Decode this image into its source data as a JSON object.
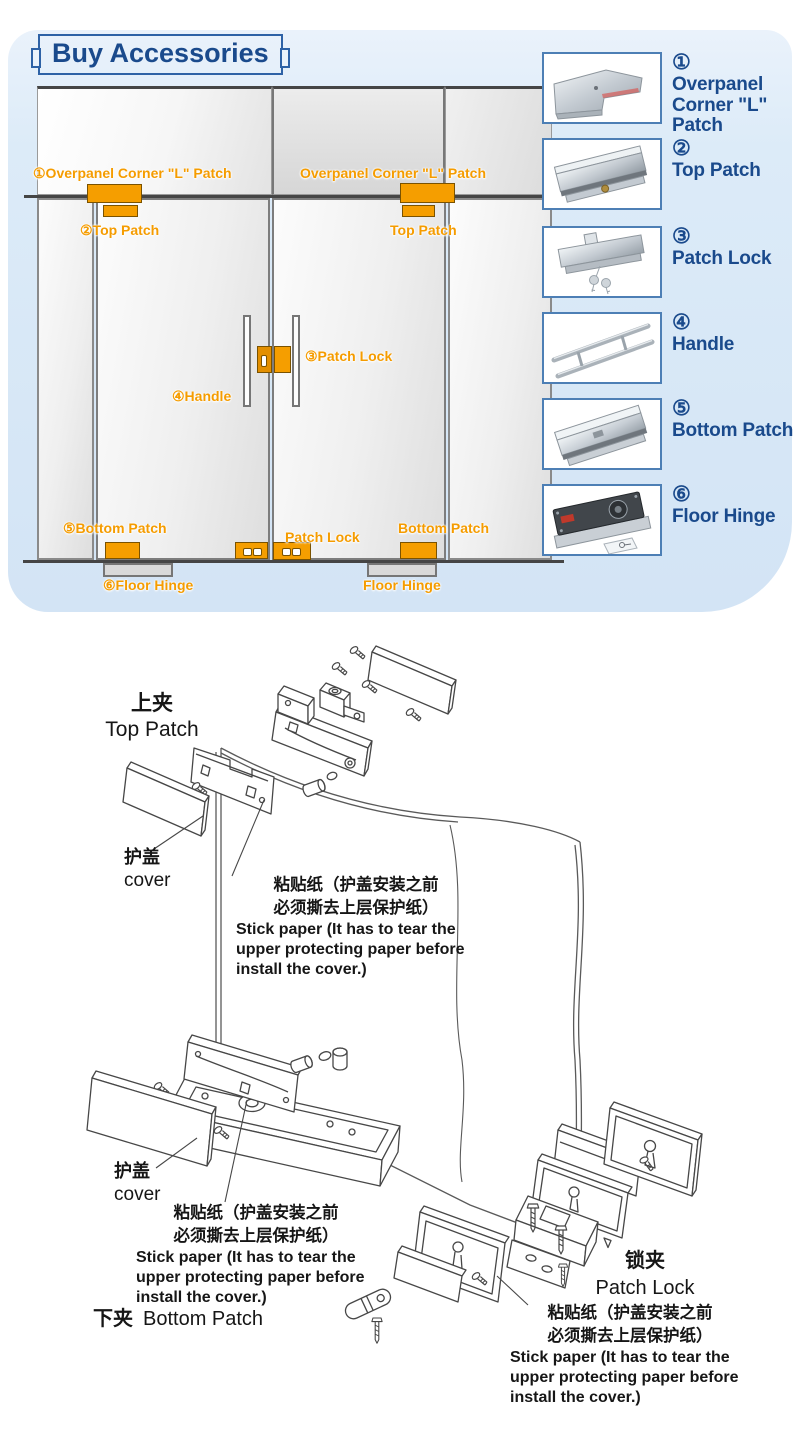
{
  "header": {
    "title": "Buy Accessories"
  },
  "door_diagram": {
    "overpanel_left": "①Overpanel Corner \"L\" Patch",
    "overpanel_right": "Overpanel Corner \"L\" Patch",
    "top_patch_left": "②Top Patch",
    "top_patch_right": "Top Patch",
    "patch_lock_mid": "③Patch Lock",
    "handle": "④Handle",
    "bottom_patch_left": "⑤Bottom Patch",
    "patch_lock_bottom": "Patch Lock",
    "bottom_patch_right": "Bottom Patch",
    "floor_hinge_left": "⑥Floor Hinge",
    "floor_hinge_right": "Floor Hinge"
  },
  "products": [
    {
      "number": "①",
      "label": "Overpanel Corner \"L\" Patch",
      "icon": "corner-l-patch"
    },
    {
      "number": "②",
      "label": "Top Patch",
      "icon": "top-patch"
    },
    {
      "number": "③",
      "label": "Patch Lock",
      "icon": "patch-lock"
    },
    {
      "number": "④",
      "label": "Handle",
      "icon": "door-handle"
    },
    {
      "number": "⑤",
      "label": "Bottom Patch",
      "icon": "bottom-patch"
    },
    {
      "number": "⑥",
      "label": "Floor Hinge",
      "icon": "floor-hinge"
    }
  ],
  "exploded": {
    "top_patch_cn": "上夹",
    "top_patch_en": "Top Patch",
    "cover_cn": "护盖",
    "cover_en": "cover",
    "stick_cn1": "粘贴纸（护盖安装之前",
    "stick_cn2": "必须撕去上层保护纸）",
    "stick_en1": "Stick paper (It has to tear the",
    "stick_en2": "upper protecting paper before",
    "stick_en3": "install the cover.)",
    "bottom_patch_cn": "下夹",
    "bottom_patch_en": "Bottom Patch",
    "patch_lock_cn": "锁夹",
    "patch_lock_en": "Patch Lock"
  },
  "colors": {
    "accent_orange": "#F59E00",
    "accent_blue": "#1A4A8C",
    "panel_bg": "#DCE9F7",
    "box_border": "#4D7FB5"
  }
}
